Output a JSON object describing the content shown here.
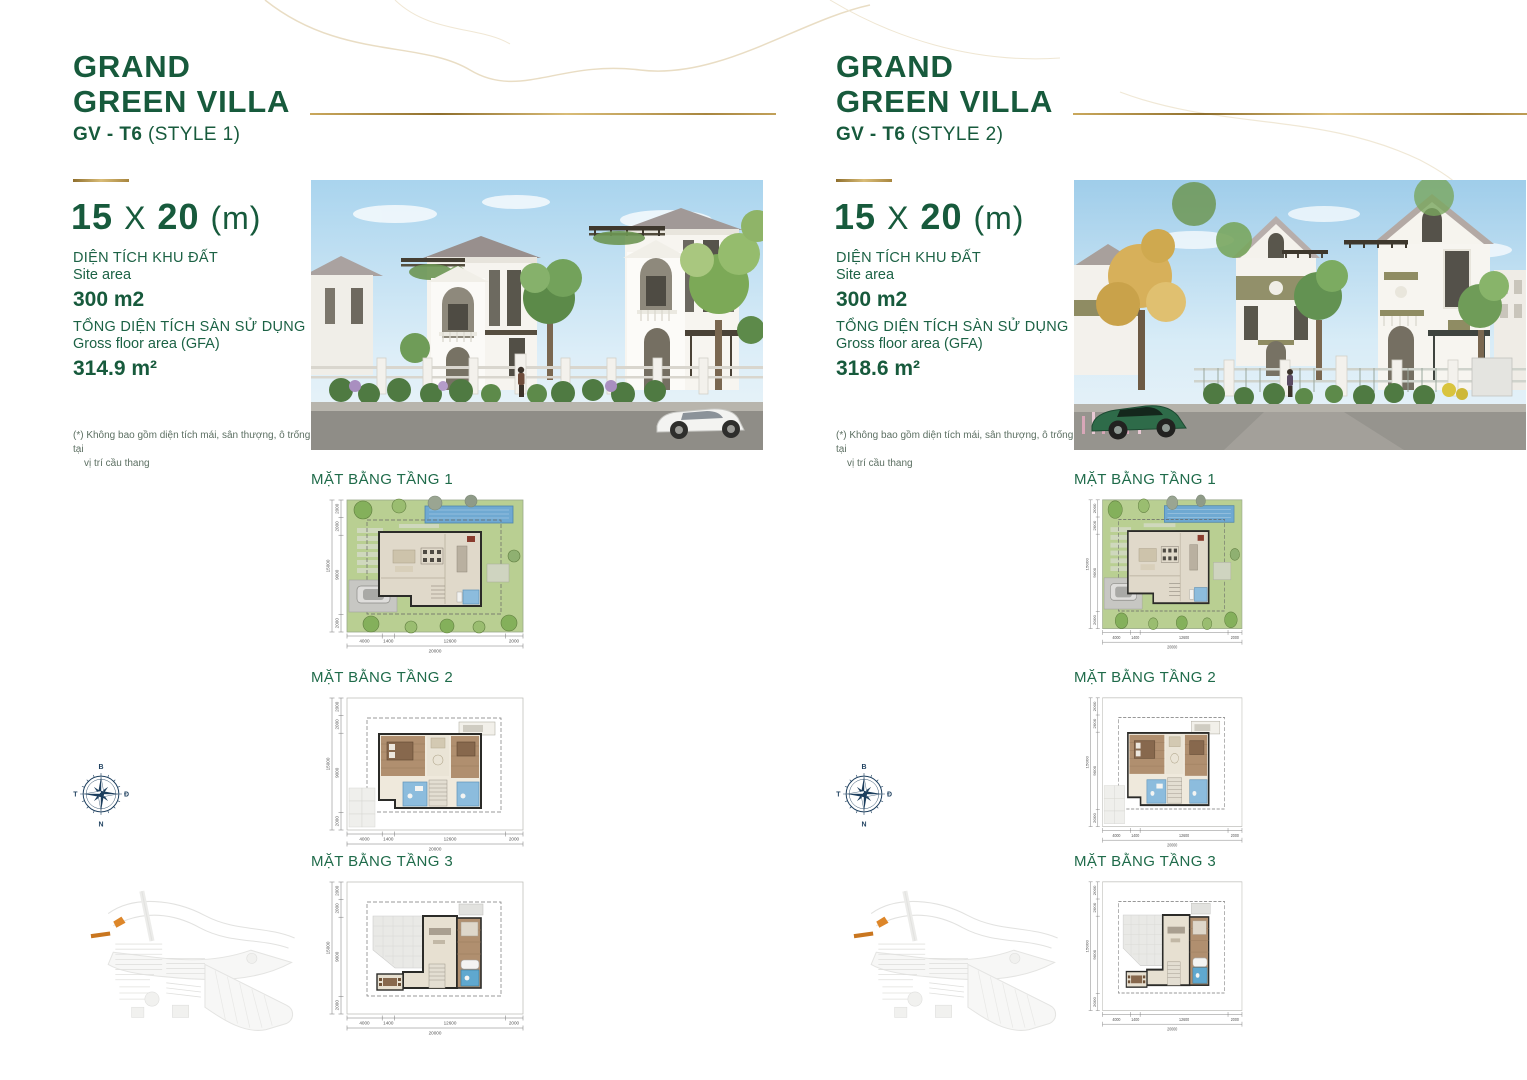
{
  "page": {
    "colors": {
      "brand_green": "#175a3c",
      "label_green": "#1f6b4a",
      "gold": "#b3903f",
      "compass_navy": "#1d3f5e",
      "plot_orange": "#dd8629",
      "pool_blue": "#6fa9d2",
      "bath_blue": "#8cbcdd",
      "wood_floor": "#b08f6f",
      "lawn_green": "#b9cf92"
    }
  },
  "compass": {
    "north": "B",
    "east": "Đ",
    "south": "N",
    "west": "T"
  },
  "plan_dims": {
    "bottom": [
      "4000",
      "1400",
      "12600",
      "2000"
    ],
    "bottom_total": "20000",
    "left": [
      "2000",
      "2000",
      "9000",
      "2000"
    ],
    "left_total": "15000"
  },
  "columns": [
    {
      "title_line1": "GRAND",
      "title_line2": "GREEN VILLA",
      "subtitle_code": "GV - T6",
      "subtitle_style": "(STYLE 1)",
      "dim_w": "15",
      "dim_sep": "X",
      "dim_d": "20",
      "dim_unit": "(m)",
      "site_area_label_vi": "DIỆN TÍCH KHU ĐẤT",
      "site_area_label_en": "Site area",
      "site_area_value": "300 m2",
      "gfa_label_vi": "TỔNG DIỆN TÍCH SÀN SỬ DỤNG",
      "gfa_label_en": "Gross floor area (GFA)",
      "gfa_value": "314.9 m²",
      "footnote_line1": "(*) Không bao gồm diện tích mái, sân thượng, ô trống tại",
      "footnote_line2": "vị trí cầu thang",
      "plan1_label": "MẶT BẰNG TẦNG 1",
      "plan2_label": "MẶT BẰNG TẦNG 2",
      "plan3_label": "MẶT BẰNG TẦNG 3"
    },
    {
      "title_line1": "GRAND",
      "title_line2": "GREEN VILLA",
      "subtitle_code": "GV - T6",
      "subtitle_style": "(STYLE 2)",
      "dim_w": "15",
      "dim_sep": "X",
      "dim_d": "20",
      "dim_unit": "(m)",
      "site_area_label_vi": "DIỆN TÍCH KHU ĐẤT",
      "site_area_label_en": "Site area",
      "site_area_value": "300 m2",
      "gfa_label_vi": "TỔNG DIỆN TÍCH SÀN SỬ DỤNG",
      "gfa_label_en": "Gross floor area (GFA)",
      "gfa_value": "318.6 m²",
      "footnote_line1": "(*) Không bao gồm diện tích mái, sân thượng, ô trống tại",
      "footnote_line2": "vị trí cầu thang",
      "plan1_label": "MẶT BẰNG TẦNG 1",
      "plan2_label": "MẶT BẰNG TẦNG 2",
      "plan3_label": "MẶT BẰNG TẦNG 3"
    }
  ]
}
